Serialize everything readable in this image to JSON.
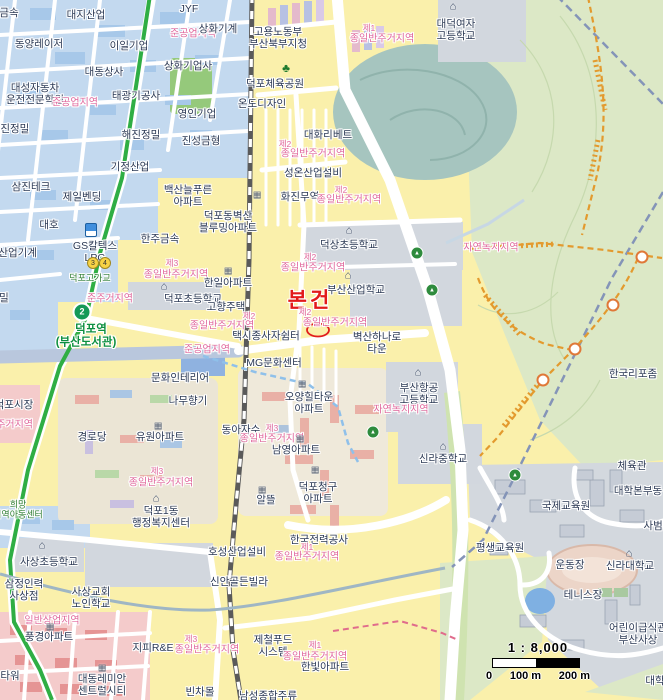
{
  "map": {
    "subject_marker": {
      "label": "본건"
    },
    "station": {
      "line_badge": "2",
      "name": "덕포역",
      "name_sub": "(부산도서관)"
    },
    "scale": {
      "ratio": "1 : 8,000",
      "ticks": [
        "0",
        "100 m",
        "200 m"
      ]
    },
    "colors": {
      "subject_red": "#e21a1a",
      "zone_pink": "#e0679c",
      "metro_green": "#2fae44",
      "trail_orange": "#e39a2e",
      "industrial_blue": "#c3d9ef",
      "forest_green": "#dce8c6",
      "school_gray": "#d2d7de",
      "commercial_pink": "#f4cbcb",
      "water_blue": "#7fb0e2",
      "rail_gray": "#5a5a5a",
      "boundary_blue": "#8494b8",
      "residential_yellow": "#faf0ab"
    },
    "glyphs": {
      "school-icon": "⌂",
      "office-icon": "⌂",
      "apartment-icon": "▦",
      "tree-icon": "♣",
      "trail-marker": "▲"
    },
    "labels": [
      {
        "t": "금속",
        "x": 9,
        "y": 13,
        "c": "co"
      },
      {
        "t": "대지산업",
        "x": 86,
        "y": 15,
        "c": "co"
      },
      {
        "t": "JYF",
        "x": 189,
        "y": 9,
        "c": "co"
      },
      {
        "t": "동양레이저",
        "x": 39,
        "y": 44,
        "c": "co"
      },
      {
        "t": "이일기업",
        "x": 129,
        "y": 46,
        "c": "co"
      },
      {
        "t": "준공업지역",
        "x": 193,
        "y": 34,
        "c": "zone"
      },
      {
        "t": "상화기계",
        "x": 218,
        "y": 29,
        "c": "co"
      },
      {
        "t": "상화기업사",
        "x": 188,
        "y": 66,
        "c": "co"
      },
      {
        "t": "대동상사",
        "x": 104,
        "y": 72,
        "c": "co"
      },
      {
        "t": "대성자동차\n운전전문학원",
        "x": 35,
        "y": 94,
        "c": "co"
      },
      {
        "t": "태광기공사",
        "x": 136,
        "y": 96,
        "c": "co"
      },
      {
        "t": "준공업지역",
        "x": 75,
        "y": 103,
        "c": "zone"
      },
      {
        "t": "영인기업",
        "x": 197,
        "y": 114,
        "c": "co"
      },
      {
        "t": "해진정밀",
        "x": 141,
        "y": 135,
        "c": "co"
      },
      {
        "t": "진성금형",
        "x": 201,
        "y": 141,
        "c": "co"
      },
      {
        "t": "금진정밀",
        "x": 10,
        "y": 129,
        "c": "co"
      },
      {
        "t": "기정산업",
        "x": 130,
        "y": 167,
        "c": "co"
      },
      {
        "t": "삼진테크",
        "x": 31,
        "y": 187,
        "c": "co"
      },
      {
        "t": "제일벤딩",
        "x": 82,
        "y": 197,
        "c": "co"
      },
      {
        "t": "대호",
        "x": 49,
        "y": 225,
        "c": "co"
      },
      {
        "t": "동양산업기계",
        "x": 8,
        "y": 253,
        "c": "co"
      },
      {
        "t": "밀",
        "x": 4,
        "y": 298,
        "c": "co"
      },
      {
        "t": "GS칼텍스\nLPG",
        "x": 95,
        "y": 252,
        "c": "co"
      },
      {
        "t": "한주금속",
        "x": 160,
        "y": 239,
        "c": "co"
      },
      {
        "t": "고용노동부\n부산북부지청",
        "x": 278,
        "y": 38,
        "c": "co"
      },
      {
        "t": "제1",
        "x": 369,
        "y": 29,
        "c": "zone-sm"
      },
      {
        "t": "종일반주거지역",
        "x": 382,
        "y": 39,
        "c": "zone"
      },
      {
        "t": "대덕여자\n고등학교",
        "x": 456,
        "y": 30,
        "c": "co"
      },
      {
        "t": "덕포체육공원",
        "x": 275,
        "y": 84,
        "c": "co"
      },
      {
        "t": "온도디자인",
        "x": 262,
        "y": 104,
        "c": "co"
      },
      {
        "t": "대화리베트",
        "x": 328,
        "y": 135,
        "c": "co"
      },
      {
        "t": "제2",
        "x": 285,
        "y": 145,
        "c": "zone-sm"
      },
      {
        "t": "종일반주거지역",
        "x": 313,
        "y": 154,
        "c": "zone"
      },
      {
        "t": "성온산업설비",
        "x": 313,
        "y": 173,
        "c": "co"
      },
      {
        "t": "화진무역",
        "x": 300,
        "y": 197,
        "c": "co"
      },
      {
        "t": "제2",
        "x": 341,
        "y": 191,
        "c": "zone-sm"
      },
      {
        "t": "종일반주거지역",
        "x": 349,
        "y": 200,
        "c": "zone"
      },
      {
        "t": "백산늘푸른\n아파트",
        "x": 188,
        "y": 196,
        "c": "co"
      },
      {
        "t": "덕포동벽산\n블루밍아파트",
        "x": 228,
        "y": 222,
        "c": "co"
      },
      {
        "t": "제3",
        "x": 172,
        "y": 264,
        "c": "zone-sm"
      },
      {
        "t": "종일반주거지역",
        "x": 176,
        "y": 275,
        "c": "zone"
      },
      {
        "t": "덕상초등학교",
        "x": 349,
        "y": 245,
        "c": "co"
      },
      {
        "t": "제2",
        "x": 310,
        "y": 258,
        "c": "zone-sm"
      },
      {
        "t": "종일반주거지역",
        "x": 313,
        "y": 268,
        "c": "zone"
      },
      {
        "t": "한일아파트",
        "x": 228,
        "y": 283,
        "c": "co"
      },
      {
        "t": "덕포초등학교",
        "x": 193,
        "y": 299,
        "c": "co"
      },
      {
        "t": "준주거지역",
        "x": 110,
        "y": 299,
        "c": "zone"
      },
      {
        "t": "덕포고가교",
        "x": 90,
        "y": 278,
        "c": "groad"
      },
      {
        "t": "덕포역",
        "x": 91,
        "y": 330,
        "c": "gstation",
        "n": "station-name"
      },
      {
        "t": "(부산도서관)",
        "x": 86,
        "y": 343,
        "c": "gstation",
        "n": "station-name-sub"
      },
      {
        "t": "고향주택",
        "x": 226,
        "y": 307,
        "c": "co"
      },
      {
        "t": "부산산업학교",
        "x": 356,
        "y": 290,
        "c": "co"
      },
      {
        "t": "본건",
        "x": 310,
        "y": 301,
        "c": "subject",
        "n": "subject-property-label"
      },
      {
        "t": "제2",
        "x": 249,
        "y": 317,
        "c": "zone-sm"
      },
      {
        "t": "종일반주거지역",
        "x": 222,
        "y": 326,
        "c": "zone"
      },
      {
        "t": "제2",
        "x": 305,
        "y": 313,
        "c": "zone-sm"
      },
      {
        "t": "종일반주거지역",
        "x": 335,
        "y": 323,
        "c": "zone"
      },
      {
        "t": "택시종사자쉼터",
        "x": 266,
        "y": 336,
        "c": "co"
      },
      {
        "t": "벽산하나로\n타운",
        "x": 377,
        "y": 343,
        "c": "co"
      },
      {
        "t": "준공업지역",
        "x": 207,
        "y": 350,
        "c": "zone"
      },
      {
        "t": "MG문화센터",
        "x": 274,
        "y": 363,
        "c": "co"
      },
      {
        "t": "부산항공\n고등학교",
        "x": 419,
        "y": 394,
        "c": "co"
      },
      {
        "t": "자연녹지지역",
        "x": 401,
        "y": 410,
        "c": "zone"
      },
      {
        "t": "자연녹지지역",
        "x": 491,
        "y": 248,
        "c": "zone"
      },
      {
        "t": "오양힐타운\n아파트",
        "x": 309,
        "y": 403,
        "c": "co"
      },
      {
        "t": "동아자수",
        "x": 241,
        "y": 430,
        "c": "co"
      },
      {
        "t": "제3",
        "x": 272,
        "y": 429,
        "c": "zone-sm"
      },
      {
        "t": "종일반주거지역",
        "x": 272,
        "y": 439,
        "c": "zone"
      },
      {
        "t": "남영아파트",
        "x": 296,
        "y": 450,
        "c": "co"
      },
      {
        "t": "신라중학교",
        "x": 443,
        "y": 459,
        "c": "co"
      },
      {
        "t": "덕포청구\n아파트",
        "x": 318,
        "y": 493,
        "c": "co"
      },
      {
        "t": "문화인테리어",
        "x": 180,
        "y": 378,
        "c": "co"
      },
      {
        "t": "나무향기",
        "x": 188,
        "y": 401,
        "c": "co"
      },
      {
        "t": "유원아파트",
        "x": 160,
        "y": 437,
        "c": "co"
      },
      {
        "t": "경로당",
        "x": 92,
        "y": 437,
        "c": "co"
      },
      {
        "t": "덕포시장",
        "x": 14,
        "y": 405,
        "c": "co"
      },
      {
        "t": "준주거지역",
        "x": 10,
        "y": 425,
        "c": "zone"
      },
      {
        "t": "제3",
        "x": 157,
        "y": 472,
        "c": "zone-sm"
      },
      {
        "t": "종일반주거지역",
        "x": 161,
        "y": 483,
        "c": "zone"
      },
      {
        "t": "덕포1동\n행정복지센터",
        "x": 161,
        "y": 517,
        "c": "co"
      },
      {
        "t": "희망\n지역아동센터",
        "x": 18,
        "y": 510,
        "c": "groad"
      },
      {
        "t": "알뜰",
        "x": 266,
        "y": 500,
        "c": "co"
      },
      {
        "t": "한국전력공사",
        "x": 319,
        "y": 540,
        "c": "co"
      },
      {
        "t": "제1",
        "x": 307,
        "y": 548,
        "c": "zone-sm"
      },
      {
        "t": "종일반주거지역",
        "x": 307,
        "y": 557,
        "c": "zone"
      },
      {
        "t": "호성산업설비",
        "x": 237,
        "y": 552,
        "c": "co"
      },
      {
        "t": "신안골든빌라",
        "x": 239,
        "y": 582,
        "c": "co"
      },
      {
        "t": "사상초등학교",
        "x": 49,
        "y": 562,
        "c": "co"
      },
      {
        "t": "삼정인력\n사상점",
        "x": 24,
        "y": 590,
        "c": "co"
      },
      {
        "t": "사상교회\n노인학교",
        "x": 91,
        "y": 598,
        "c": "co"
      },
      {
        "t": "일반상업지역",
        "x": 52,
        "y": 621,
        "c": "zone"
      },
      {
        "t": "풍경아파트",
        "x": 49,
        "y": 637,
        "c": "co"
      },
      {
        "t": "지피R&E",
        "x": 153,
        "y": 648,
        "c": "co"
      },
      {
        "t": "제3",
        "x": 191,
        "y": 640,
        "c": "zone-sm"
      },
      {
        "t": "종일반주거지역",
        "x": 207,
        "y": 650,
        "c": "zone"
      },
      {
        "t": "대동레미안\n센트럴시티",
        "x": 102,
        "y": 685,
        "c": "co"
      },
      {
        "t": "빈차몰",
        "x": 200,
        "y": 692,
        "c": "co"
      },
      {
        "t": "타워",
        "x": 10,
        "y": 676,
        "c": "co"
      },
      {
        "t": "제철푸드\n시스템",
        "x": 273,
        "y": 646,
        "c": "co"
      },
      {
        "t": "제1",
        "x": 315,
        "y": 646,
        "c": "zone-sm"
      },
      {
        "t": "종일반주거지역",
        "x": 315,
        "y": 657,
        "c": "zone"
      },
      {
        "t": "한빛아파트",
        "x": 325,
        "y": 667,
        "c": "co"
      },
      {
        "t": "남성종합주류",
        "x": 268,
        "y": 696,
        "c": "co"
      },
      {
        "t": "한국리포좀",
        "x": 633,
        "y": 374,
        "c": "co"
      },
      {
        "t": "신라대학교",
        "x": 630,
        "y": 566,
        "c": "co"
      },
      {
        "t": "평생교육원",
        "x": 500,
        "y": 548,
        "c": "co"
      },
      {
        "t": "운동장",
        "x": 570,
        "y": 565,
        "c": "co"
      },
      {
        "t": "테니스장",
        "x": 583,
        "y": 595,
        "c": "co"
      },
      {
        "t": "체육관",
        "x": 632,
        "y": 466,
        "c": "co"
      },
      {
        "t": "대학본부동",
        "x": 638,
        "y": 491,
        "c": "co"
      },
      {
        "t": "국제교육원",
        "x": 566,
        "y": 506,
        "c": "co"
      },
      {
        "t": "사범대",
        "x": 658,
        "y": 526,
        "c": "co"
      },
      {
        "t": "어린이급식관\n부산사상",
        "x": 638,
        "y": 634,
        "c": "co"
      },
      {
        "t": "대학",
        "x": 655,
        "y": 681,
        "c": "co"
      }
    ],
    "icons": [
      {
        "k": "tree-icon",
        "x": 286,
        "y": 68
      },
      {
        "k": "school-icon",
        "x": 453,
        "y": 7
      },
      {
        "k": "school-icon",
        "x": 349,
        "y": 231
      },
      {
        "k": "school-icon",
        "x": 348,
        "y": 276
      },
      {
        "k": "school-icon",
        "x": 164,
        "y": 287
      },
      {
        "k": "school-icon",
        "x": 418,
        "y": 373
      },
      {
        "k": "school-icon",
        "x": 443,
        "y": 447
      },
      {
        "k": "school-icon",
        "x": 42,
        "y": 546
      },
      {
        "k": "school-icon",
        "x": 629,
        "y": 554
      },
      {
        "k": "apartment-icon",
        "x": 257,
        "y": 195
      },
      {
        "k": "apartment-icon",
        "x": 228,
        "y": 271
      },
      {
        "k": "apartment-icon",
        "x": 302,
        "y": 384
      },
      {
        "k": "apartment-icon",
        "x": 300,
        "y": 439
      },
      {
        "k": "apartment-icon",
        "x": 315,
        "y": 470
      },
      {
        "k": "apartment-icon",
        "x": 158,
        "y": 426
      },
      {
        "k": "apartment-icon",
        "x": 50,
        "y": 627
      },
      {
        "k": "apartment-icon",
        "x": 102,
        "y": 668
      },
      {
        "k": "apartment-icon",
        "x": 262,
        "y": 490
      },
      {
        "k": "office-icon",
        "x": 156,
        "y": 499
      },
      {
        "k": "gas-icon",
        "x": 91,
        "y": 230
      },
      {
        "k": "metro-badge",
        "x": 82,
        "y": 312,
        "t": "2",
        "n": "metro-line2-badge"
      },
      {
        "k": "route-badge",
        "x": 93,
        "y": 263,
        "t": "3"
      },
      {
        "k": "route-badge",
        "x": 105,
        "y": 263,
        "t": "4"
      },
      {
        "k": "trail-marker",
        "x": 417,
        "y": 253
      },
      {
        "k": "trail-marker",
        "x": 432,
        "y": 290
      },
      {
        "k": "trail-marker",
        "x": 373,
        "y": 432
      },
      {
        "k": "trail-marker",
        "x": 515,
        "y": 475
      },
      {
        "k": "spring-marker",
        "x": 642,
        "y": 257
      },
      {
        "k": "spring-marker",
        "x": 613,
        "y": 305
      },
      {
        "k": "spring-marker",
        "x": 575,
        "y": 349
      },
      {
        "k": "spring-marker",
        "x": 543,
        "y": 380
      }
    ]
  }
}
